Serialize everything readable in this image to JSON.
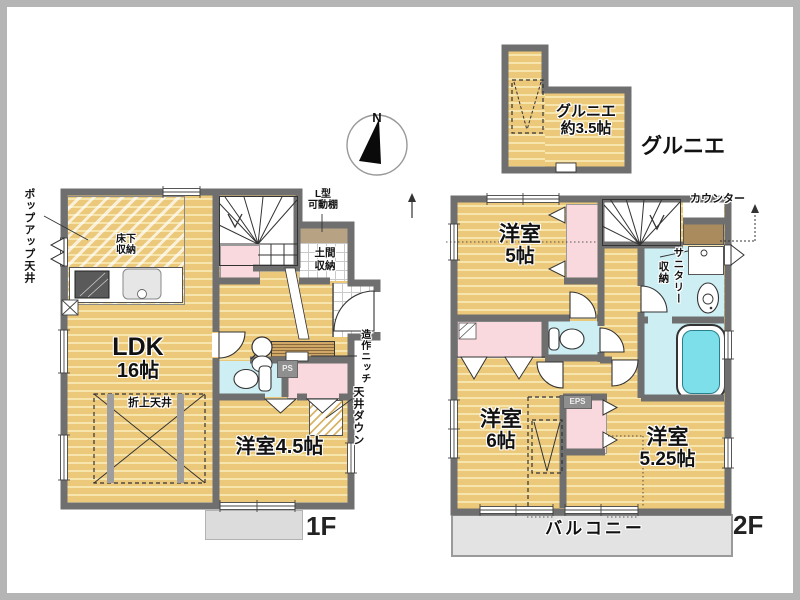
{
  "colors": {
    "floor_wood": "#ecc87b",
    "floor_stripe": "#f6e6ae",
    "wall_gray": "#6f6f6f",
    "closet_pink": "#f9d9dd",
    "wet_area_cyan": "#cdeff4",
    "tub_water": "#7cdfe9",
    "balcony_gray": "#e3e3e3",
    "counter_brown": "#a98b5e",
    "shelf_brown": "#b7a384"
  },
  "north": {
    "letter": "N"
  },
  "grenier": {
    "room_label": [
      "グルニエ",
      "約3.5帖"
    ],
    "caption": "グルニエ"
  },
  "floor1": {
    "caption": "1F",
    "ldk": [
      "LDK",
      "16帖"
    ],
    "room45": "洋室4.5帖",
    "popup_ceiling": "ポップアップ天井",
    "underfloor": [
      "床下",
      "収納"
    ],
    "l_shelf": [
      "L型",
      "可動棚"
    ],
    "doma": [
      "土間",
      "収納"
    ],
    "oriage": "折上天井",
    "ps": "PS",
    "niche": "造作ニッチ",
    "ceiling_down": "天井ダウン"
  },
  "floor2": {
    "caption": "2F",
    "room5": [
      "洋室",
      "5帖"
    ],
    "room6": [
      "洋室",
      "6帖"
    ],
    "room525": [
      "洋室",
      "5.25帖"
    ],
    "counter": "カウンター",
    "sanitary": [
      "サニタリー",
      "収納"
    ],
    "eps": "EPS",
    "balcony": "バルコニー"
  }
}
